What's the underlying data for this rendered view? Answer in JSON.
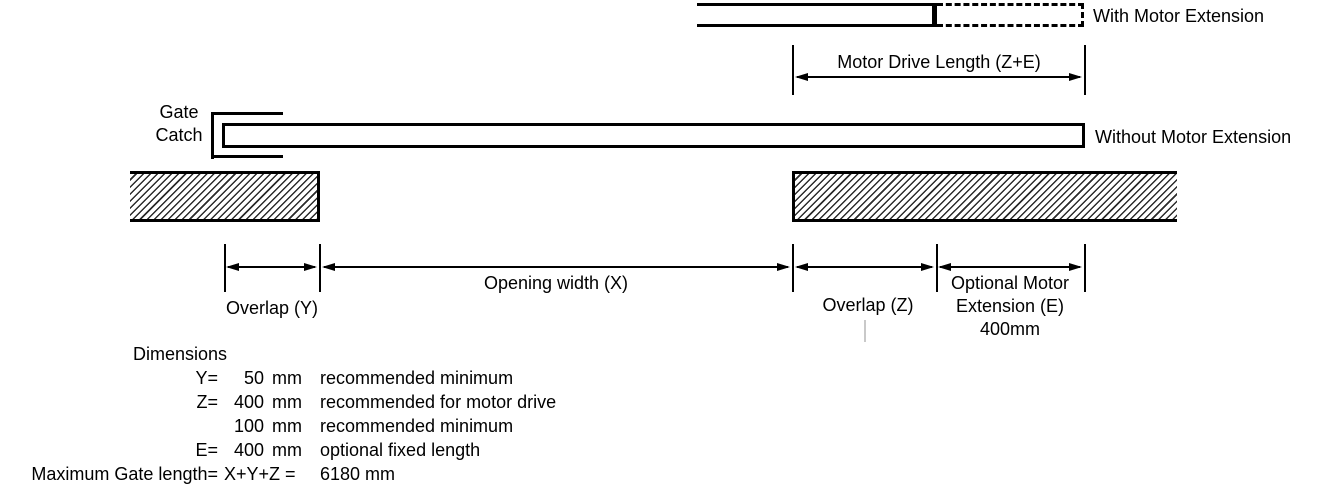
{
  "labels": {
    "with_motor": "With Motor Extension",
    "without_motor": "Without Motor Extension",
    "motor_drive": "Motor Drive Length (Z+E)",
    "gate_catch_line1": "Gate",
    "gate_catch_line2": "Catch",
    "overlap_y": "Overlap (Y)",
    "opening_x": "Opening width (X)",
    "overlap_z": "Overlap (Z)",
    "ext_line1": "Optional Motor",
    "ext_line2": "Extension (E)",
    "ext_line3": "400mm"
  },
  "notes": {
    "title": "Dimensions",
    "rows": [
      {
        "label": "Y=",
        "value": "50",
        "unit": "mm",
        "desc": "recommended minimum"
      },
      {
        "label": "Z=",
        "value": "400",
        "unit": "mm",
        "desc": "recommended for motor drive"
      },
      {
        "label": "",
        "value": "100",
        "unit": "mm",
        "desc": "recommended minimum"
      },
      {
        "label": "E=",
        "value": "400",
        "unit": "mm",
        "desc": "optional fixed length"
      },
      {
        "label": "Maximum Gate length=",
        "value": "X+Y+Z =",
        "unit": "",
        "desc": "6180 mm"
      }
    ]
  },
  "colors": {
    "line": "#000000",
    "background": "#ffffff",
    "artifact": "#c9c9c9"
  }
}
